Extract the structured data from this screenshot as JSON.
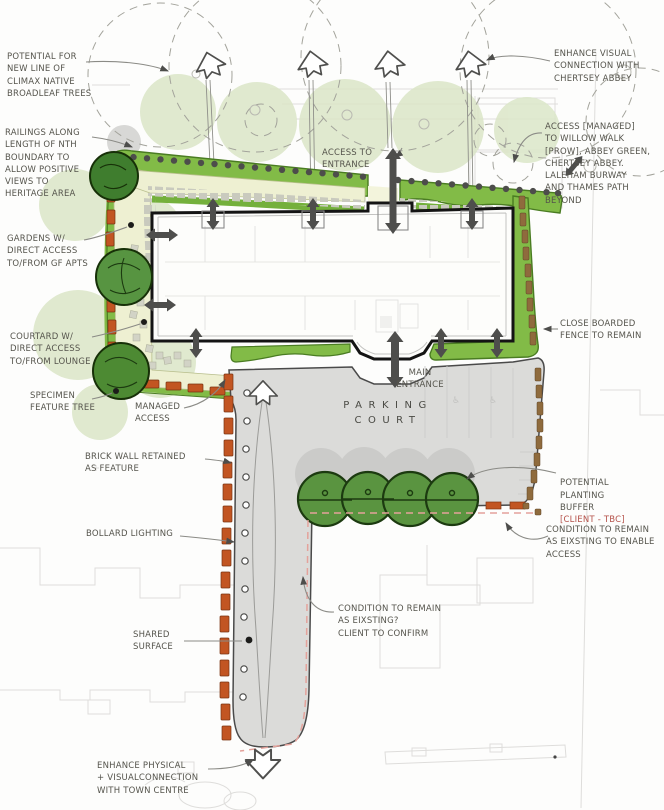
{
  "annotations": {
    "potential_trees": {
      "lines": [
        "POTENTIAL FOR",
        "NEW LINE OF",
        "CLIMAX NATIVE",
        "BROADLEAF TREES"
      ]
    },
    "enhance_visual": {
      "lines": [
        "ENHANCE VISUAL",
        "CONNECTION WITH",
        "CHERTSEY ABBEY"
      ]
    },
    "railings": {
      "lines": [
        "RAILINGS ALONG",
        "LENGTH OF NTH",
        "BOUNDARY TO",
        "ALLOW POSITIVE",
        "VIEWS TO",
        "HERITAGE AREA"
      ]
    },
    "access_to_entrance": {
      "lines": [
        "ACCESS TO",
        "ENTRANCE"
      ]
    },
    "access_managed": {
      "lines": [
        "ACCESS [MANAGED]",
        "TO WILLOW WALK",
        "[PROW], ABBEY GREEN,",
        "CHERTSEY ABBEY.",
        "LALEHAM BURWAY",
        "AND THAMES PATH",
        "BEYOND"
      ]
    },
    "gardens": {
      "lines": [
        "GARDENS W/",
        "DIRECT ACCESS",
        "TO/FROM GF APTS"
      ]
    },
    "courtyard": {
      "lines": [
        "COURTARD W/",
        "DIRECT ACCESS",
        "TO/FROM LOUNGE"
      ]
    },
    "close_boarded": {
      "lines": [
        "CLOSE BOARDED",
        "FENCE TO REMAIN"
      ]
    },
    "specimen": {
      "lines": [
        "SPECIMEN",
        "FEATURE TREE"
      ]
    },
    "managed_access": {
      "lines": [
        "MANAGED",
        "ACCESS"
      ]
    },
    "main_entrance": {
      "lines": [
        "MAIN",
        "ENTRANCE"
      ]
    },
    "parking_court": {
      "lines": [
        "PARKING",
        "COURT"
      ]
    },
    "brick_wall": {
      "lines": [
        "BRICK WALL RETAINED",
        "AS FEATURE"
      ]
    },
    "planting_buffer": {
      "lines": [
        "POTENTIAL",
        "PLANTING",
        "BUFFER"
      ],
      "tbc": "[CLIENT - TBC]"
    },
    "bollard": {
      "lines": [
        "BOLLARD LIGHTING"
      ]
    },
    "condition_access": {
      "lines": [
        "CONDITION TO REMAIN",
        "AS EIXSTING TO ENABLE",
        "ACCESS"
      ]
    },
    "condition_confirm": {
      "lines": [
        "CONDITION TO REMAIN",
        "AS EIXSTING?",
        "CLIENT TO CONFIRM"
      ]
    },
    "shared_surface": {
      "lines": [
        "SHARED",
        "SURFACE"
      ]
    },
    "enhance_physical": {
      "lines": [
        "ENHANCE PHYSICAL",
        "+ VISUALCONNECTION",
        "WITH TOWN CENTRE"
      ]
    }
  },
  "icons": {
    "disabled_bay": "♿"
  },
  "colors": {
    "planting_green": "#82bb47",
    "tree_green": "#4d8a33",
    "brick_orange": "#c25522",
    "fence_brown": "#8f6b3d",
    "parking_grey": "#dbdbd9",
    "note_red": "#b5524a",
    "ink": "#55544c"
  }
}
